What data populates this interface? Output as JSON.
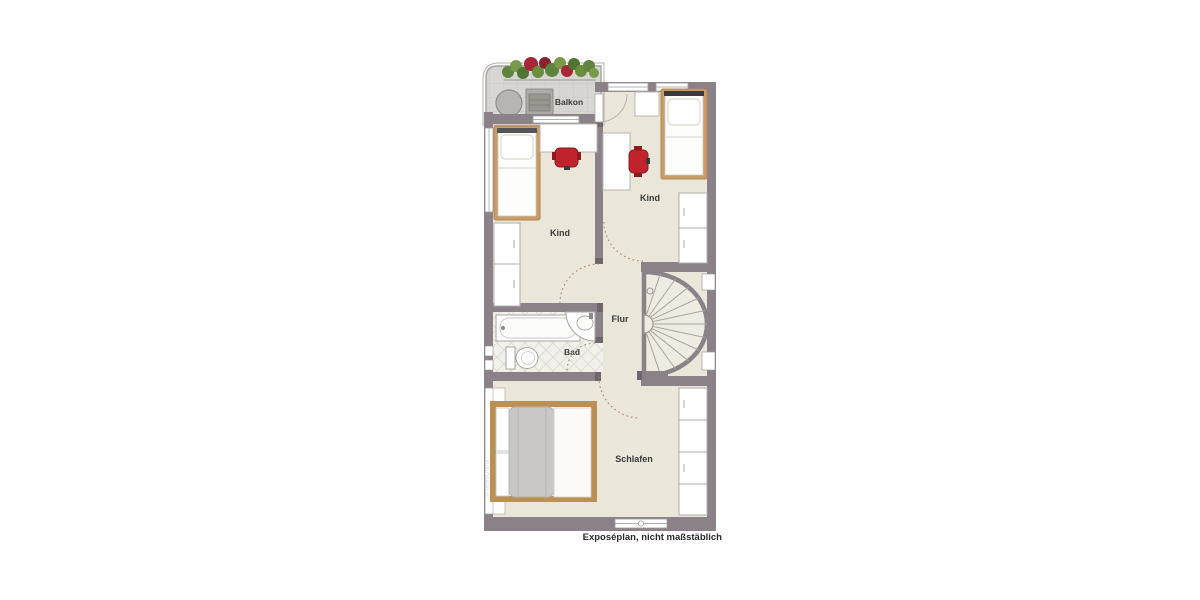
{
  "plan": {
    "type": "floorplan",
    "caption": "Exposéplan, nicht maßstäblich",
    "watermark": "© ImmoGrafik",
    "rooms": [
      {
        "name": "balkon",
        "label": "Balkon",
        "furniture": [
          "round-table",
          "bench",
          "flower-boxes"
        ]
      },
      {
        "name": "kind-left",
        "label": "Kind",
        "furniture": [
          "single-bed",
          "desk",
          "red-chair",
          "wardrobe"
        ]
      },
      {
        "name": "kind-right",
        "label": "Kind",
        "furniture": [
          "single-bed",
          "nightstand",
          "desk",
          "red-chair",
          "wardrobe"
        ]
      },
      {
        "name": "flur",
        "label": "Flur",
        "furniture": [
          "spiral-staircase"
        ]
      },
      {
        "name": "bad",
        "label": "Bad",
        "furniture": [
          "bathtub",
          "washbasin",
          "wc"
        ]
      },
      {
        "name": "schlafen",
        "label": "Schlafen",
        "furniture": [
          "double-bed",
          "built-in-closet"
        ]
      }
    ],
    "colors": {
      "wall": "#8b8289",
      "floor": "#eae6da",
      "balcony_floor": "#d7d6d3",
      "bath_tile": "#f1f0ea",
      "wood_frame": "#c49a62",
      "chair_red": "#c0232c",
      "blanket_gray": "#c8c7c4",
      "door_swing_dashed": "#ad8a74",
      "plant_green": "#5f8440",
      "plant_red": "#a92636"
    }
  }
}
